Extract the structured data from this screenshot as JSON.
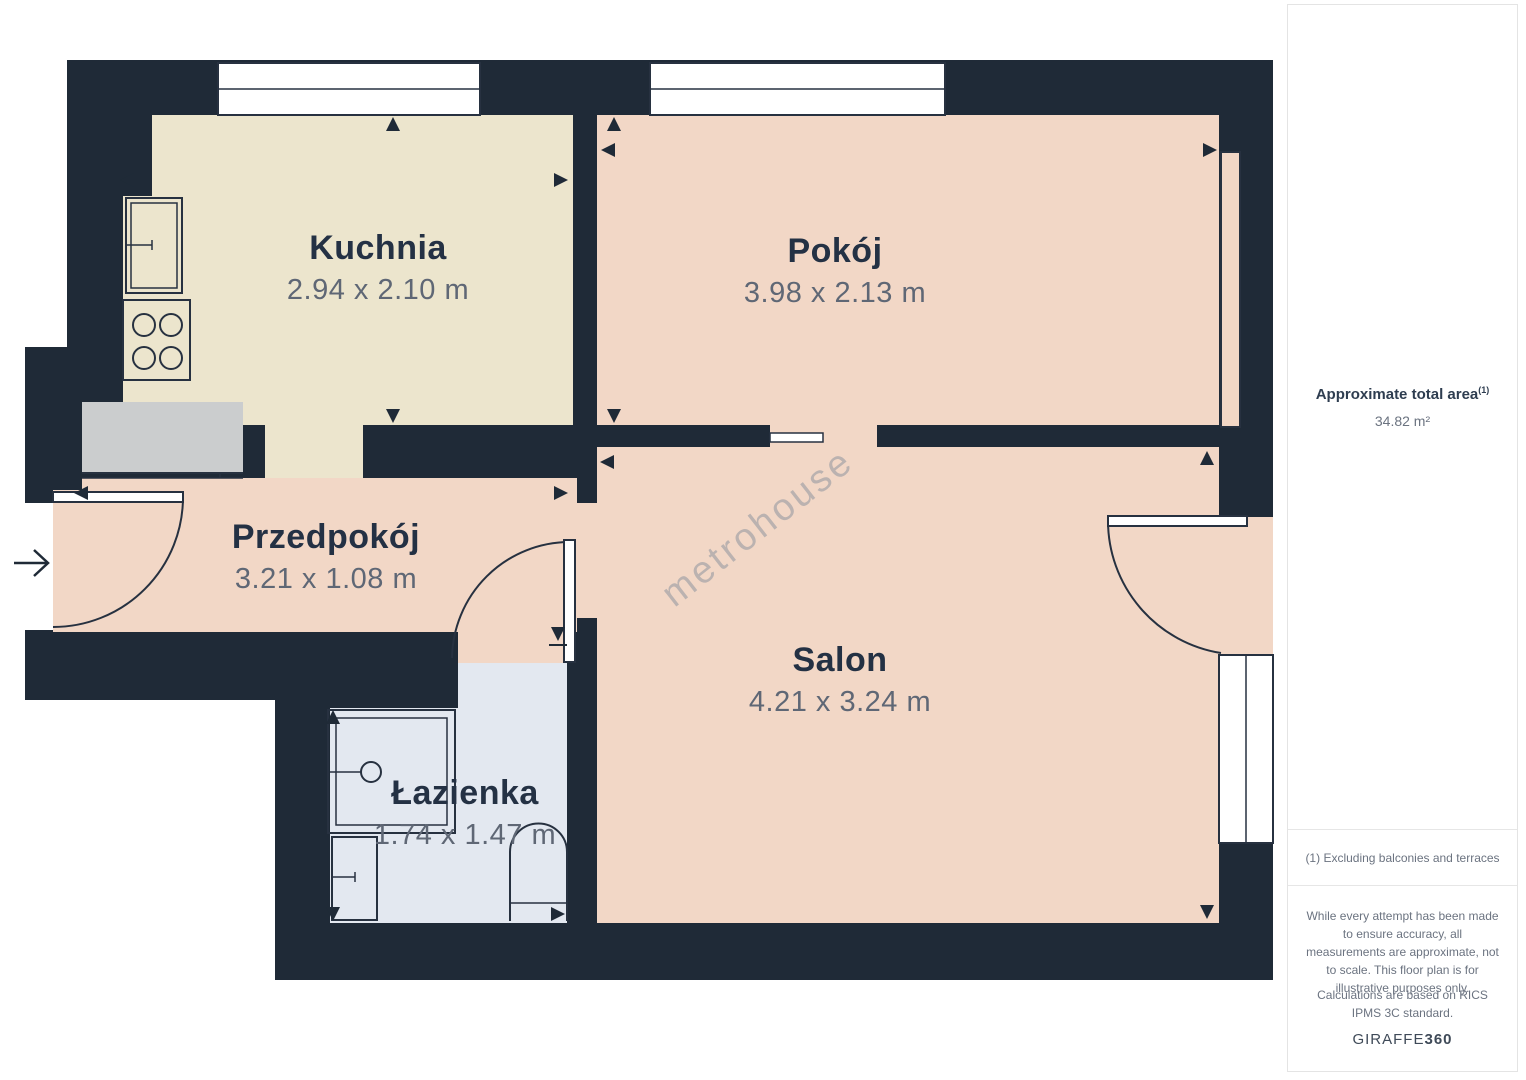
{
  "floor_plan": {
    "watermark": "metrohouse",
    "rooms": [
      {
        "name": "Kuchnia",
        "dimensions": "2.94 x 2.10 m"
      },
      {
        "name": "Pokój",
        "dimensions": "3.98 x 2.13 m"
      },
      {
        "name": "Przedpokój",
        "dimensions": "3.21 x 1.08 m"
      },
      {
        "name": "Salon",
        "dimensions": "4.21 x 3.24 m"
      },
      {
        "name": "Łazienka",
        "dimensions": "1.74 x 1.47 m"
      }
    ],
    "colors": {
      "wall": "#1f2a37",
      "room_warm": "#f2d7c6",
      "room_kitchen": "#ece5cd",
      "room_bath": "#e3e8f0",
      "counter": "#cbcdce",
      "room_name_text": "#243144",
      "dimension_text": "#5f6775"
    }
  },
  "sidebar": {
    "total_area_label": "Approximate total area",
    "total_area_note_ref": "(1)",
    "total_area_value": "34.82 m²",
    "footnote": "(1) Excluding balconies and terraces",
    "disclaimer": "While every attempt has been made to ensure accuracy, all measurements are approximate, not to scale. This floor plan is for illustrative purposes only.",
    "standard_note": "Calculations are based on RICS IPMS 3C standard.",
    "brand_name": "GIRAFFE",
    "brand_number": "360"
  }
}
